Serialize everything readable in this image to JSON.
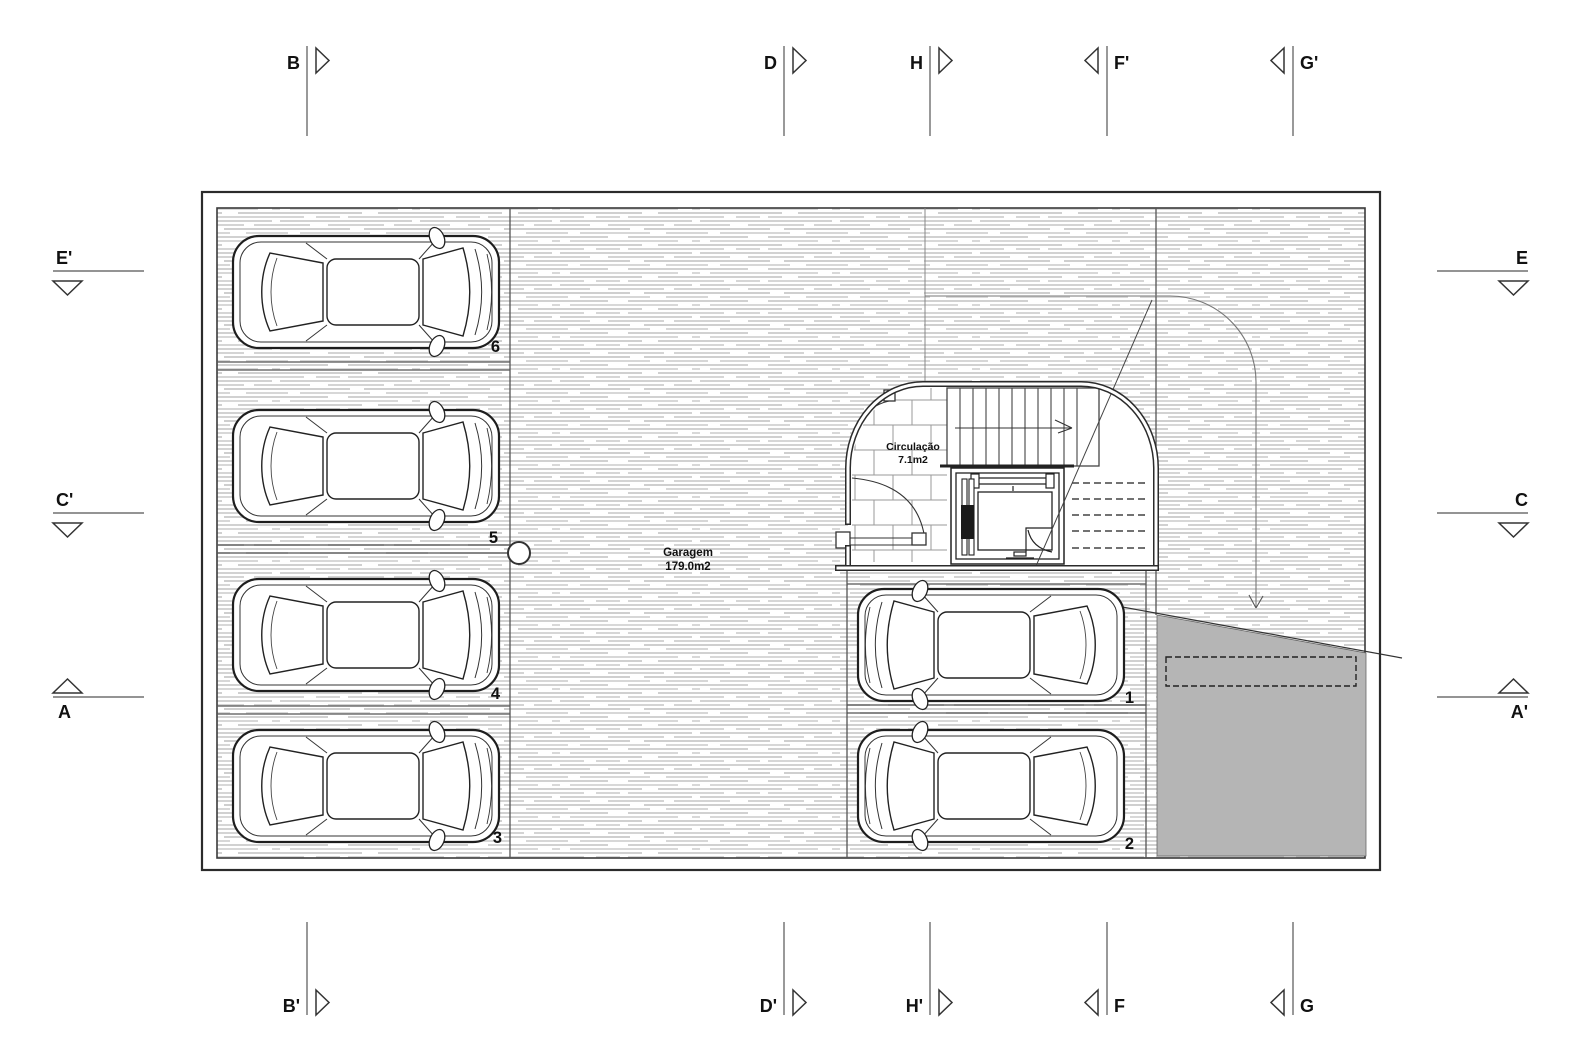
{
  "drawing": {
    "type": "architectural-floor-plan",
    "rooms": {
      "garage": {
        "name": "Garagem",
        "area": "179.0m2"
      },
      "circulation": {
        "name": "Circulação",
        "area": "7.1m2"
      }
    },
    "spots": {
      "s1": "1",
      "s2": "2",
      "s3": "3",
      "s4": "4",
      "s5": "5",
      "s6": "6"
    },
    "sections": {
      "top": [
        {
          "label": "B"
        },
        {
          "label": "D"
        },
        {
          "label": "H"
        },
        {
          "label": "F'"
        },
        {
          "label": "G'"
        }
      ],
      "bottom": [
        {
          "label": "B'"
        },
        {
          "label": "D'"
        },
        {
          "label": "H'"
        },
        {
          "label": "F"
        },
        {
          "label": "G"
        }
      ],
      "left": [
        {
          "label": "E'"
        },
        {
          "label": "C'"
        },
        {
          "label": "A"
        }
      ],
      "right": [
        {
          "label": "E"
        },
        {
          "label": "C"
        },
        {
          "label": "A'"
        }
      ]
    },
    "colors": {
      "ramp": "#b5b5b5",
      "line": "#333333",
      "hatch": "#d4d4d4",
      "tile": "#9a9a9a"
    }
  }
}
